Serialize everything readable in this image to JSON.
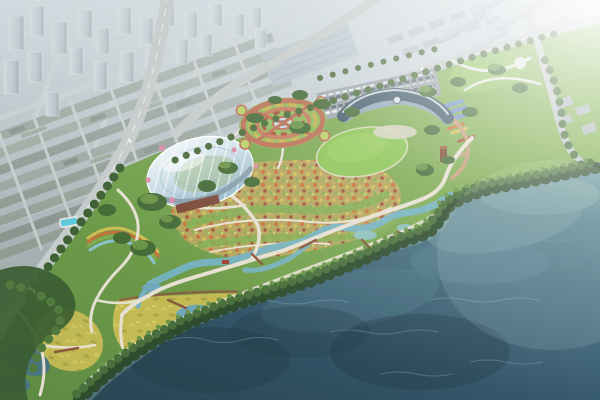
{
  "scene": {
    "type": "aerial-architectural-rendering",
    "description": "Bird's-eye masterplan rendering of a lakeside botanical park: hazy grey city district in the upper left, rows of apartment slabs upper right, a glass conservatory dome, circular formal garden, crescent visitor center with great lawn, colorful flower parterre fields, wetland streams and wildflower meadows, dense shoreline tree belt, and a large dark teal lake filling the lower right.",
    "features": {
      "city_district": "hazy city blocks",
      "highrise_towers": "high-rise tower cluster",
      "lowrise_blocks": "low-rise block grid",
      "industrial_halls": "industrial halls and warehouses",
      "apartment_slabs": "apartment slab rows",
      "west_highway": "curved western highway",
      "north_boulevard": "tree-lined boundary boulevard",
      "conservatory_dome": "glass conservatory dome",
      "formal_circle_garden": "circular parterre garden with fountain",
      "visitor_center": "crescent visitor center",
      "parking_lot": "visitor parking lot",
      "great_lawn": "oval great lawn",
      "flower_parterre": "patterned flower fields",
      "community_gardens": "community garden plots",
      "greenhouse_sheds": "blue-roofed greenhouse sheds",
      "swimming_pool": "aqua pool terrace",
      "wetland_stream": "winding wetland stream",
      "wildflower_meadow": "yellow wildflower meadow",
      "walking_paths": "white walking paths",
      "boardwalks": "timber boardwalks",
      "red_footbridges": "red footbridges",
      "shoreline_tree_belt": "dense shoreline tree belt",
      "lake": "lake water",
      "sun_glare": "sunlight glare from upper right"
    }
  },
  "palette": {
    "city_haze": "#aeb9be",
    "tower_face": "#b4bec4",
    "lowrise_roof": "#8f9a90",
    "road_grey": "#c5cbca",
    "apartment_face": "#b7c1c6",
    "park_green": "#77a54e",
    "lawn_green": "#8cc455",
    "meadow_yellow": "#c4ba54",
    "flower_base": "#b3a45c",
    "dome_glass": "#cfe0e8",
    "dome_base": "#7b4a3a",
    "visitor_roof": "#415a6a",
    "circle_brick": "#bd6a52",
    "stream_teal": "#74b2c2",
    "pool_aqua": "#5fc8da",
    "path_white": "#e6e0d2",
    "plaza_brick": "#c49b79",
    "boardwalk_brown": "#8a5a3c",
    "bridge_red": "#a33f2e",
    "tree_dark": "#2f4d2e",
    "tree_mid": "#49703c",
    "tree_light": "#6a9448",
    "water_deep": "#2b4a59",
    "water_mid": "#35596a",
    "water_light": "#6f9aa0",
    "water_shallow": "#8fb5ac",
    "shed_blue": "#6f94c4",
    "glare_white": "#ffffff"
  }
}
